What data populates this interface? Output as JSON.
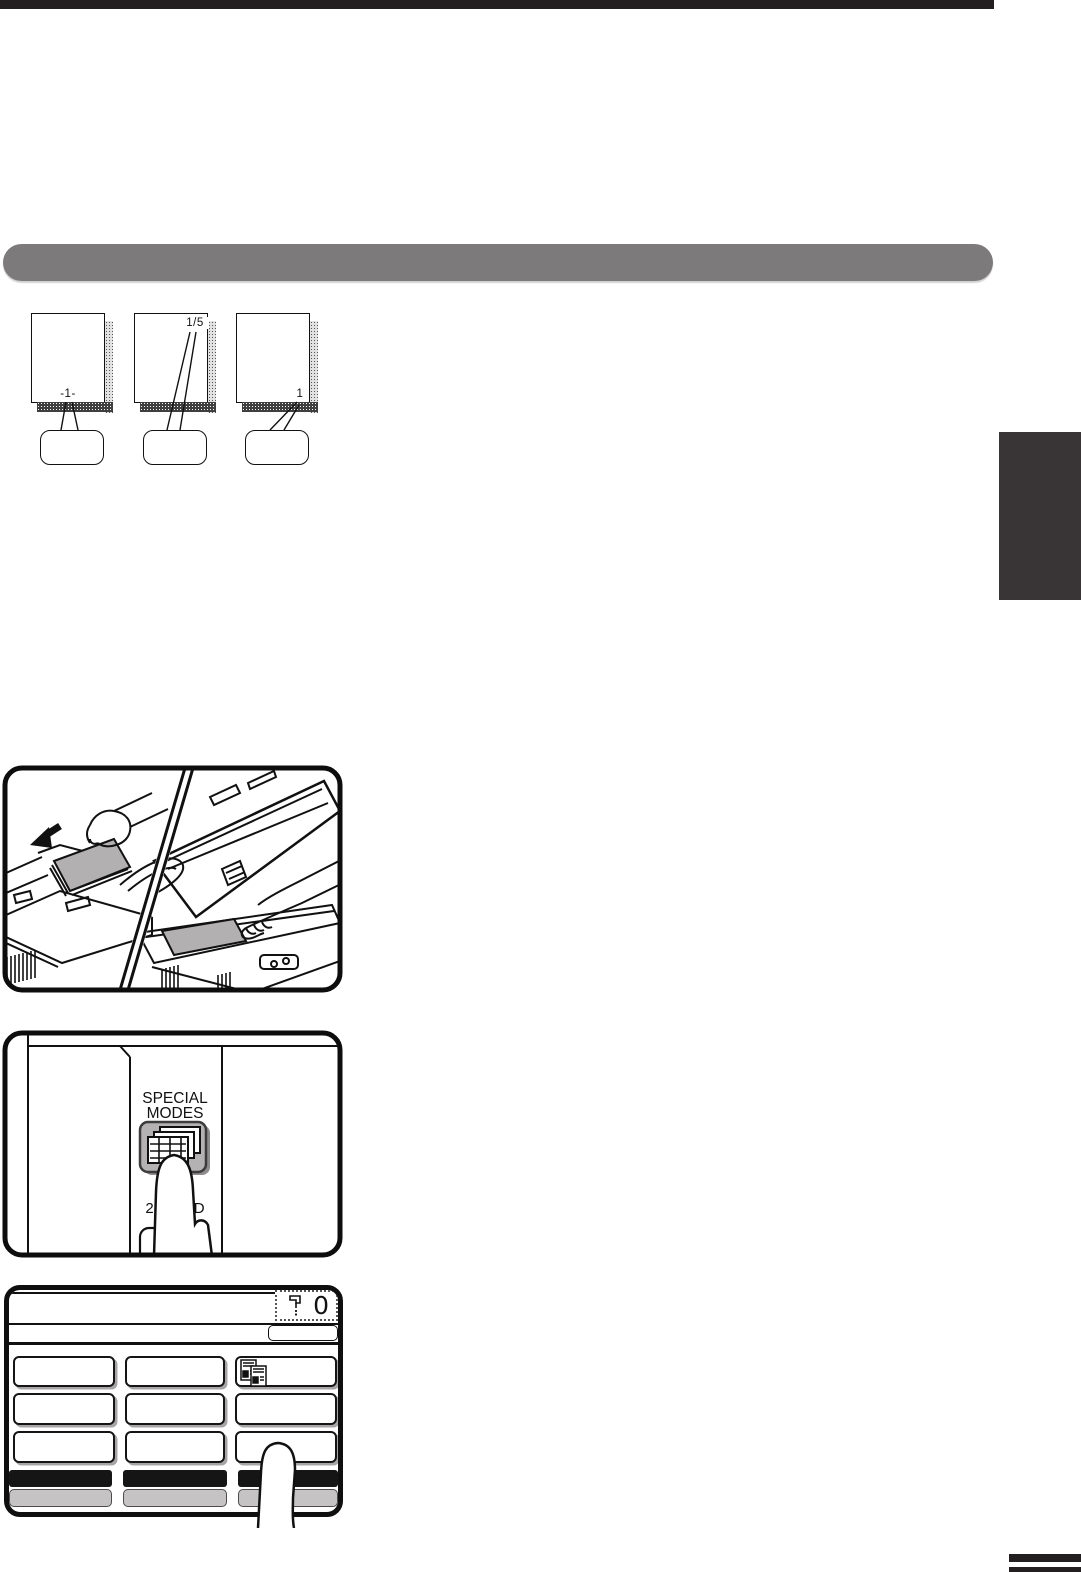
{
  "page": {
    "colors": {
      "rule_black": "#231f20",
      "header_bar_gray": "#7d7a7b",
      "section_tab_gray": "#393435",
      "paper_gray": "#b3b0b1",
      "key_gray": "#b5b2b3",
      "soft_key_gray": "#c6c3c4"
    }
  },
  "page_number_diagram": {
    "pages": [
      {
        "label": "-1-",
        "label_position": "bottom-center"
      },
      {
        "label": "1/5",
        "label_position": "top-right"
      },
      {
        "label": "1",
        "label_position": "bottom-right"
      }
    ]
  },
  "figures": {
    "originals_illustration": {
      "description": "placing originals in document feeder and on document glass"
    },
    "special_modes_panel": {
      "key_label_line1": "SPECIAL",
      "key_label_line2": "MODES",
      "below_key_label_line1": "2-SIDED",
      "below_key_label_line2": "COPY"
    },
    "touch_panel": {
      "copy_count": "0"
    }
  },
  "icons": {
    "feed_direction": "arrow-down-left-icon",
    "special_modes_key": "stacked-pages-icon",
    "grid_key": "dual-page-copy-icon",
    "counter": "copy-counter-icon"
  }
}
